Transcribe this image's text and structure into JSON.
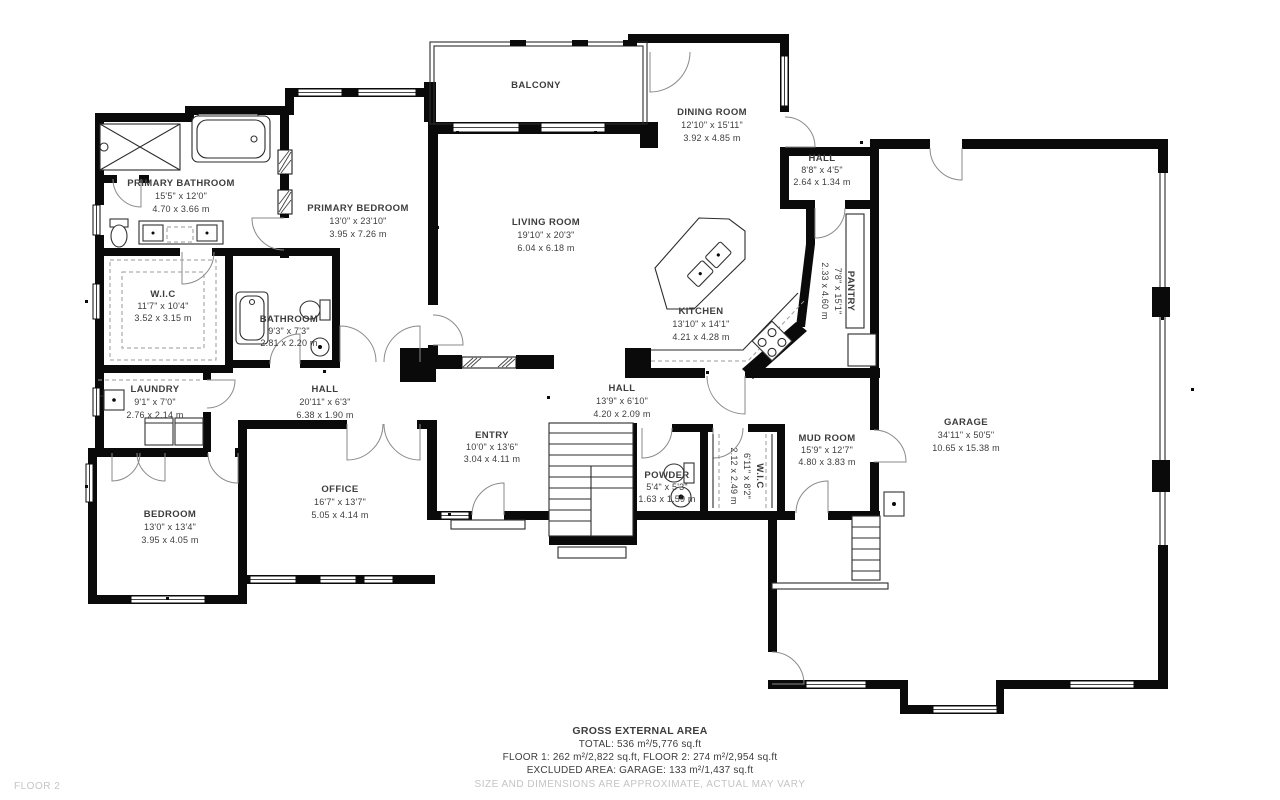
{
  "plan": {
    "floor_label": "FLOOR 2",
    "colors": {
      "wall": "#0a0a0a",
      "text": "#3d3d3d",
      "muted": "#c4c4c4",
      "background": "#ffffff"
    },
    "footer": {
      "title": "GROSS EXTERNAL AREA",
      "total": "TOTAL: 536 m²/5,776 sq.ft",
      "floors": "FLOOR 1: 262 m²/2,822 sq.ft, FLOOR 2: 274 m²/2,954 sq.ft",
      "excluded": "EXCLUDED AREA: GARAGE: 133 m²/1,437 sq.ft",
      "disclaimer": "SIZE AND DIMENSIONS ARE APPROXIMATE, ACTUAL MAY VARY"
    },
    "rooms": [
      {
        "id": "balcony",
        "name": "BALCONY",
        "dims_ft": "",
        "dims_m": ""
      },
      {
        "id": "primary-bathroom",
        "name": "PRIMARY BATHROOM",
        "dims_ft": "15'5\" x 12'0\"",
        "dims_m": "4.70 x 3.66 m"
      },
      {
        "id": "primary-bedroom",
        "name": "PRIMARY BEDROOM",
        "dims_ft": "13'0\" x 23'10\"",
        "dims_m": "3.95 x 7.26 m"
      },
      {
        "id": "dining-room",
        "name": "DINING ROOM",
        "dims_ft": "12'10\" x 15'11\"",
        "dims_m": "3.92 x 4.85 m"
      },
      {
        "id": "hall-upper",
        "name": "HALL",
        "dims_ft": "8'8\" x 4'5\"",
        "dims_m": "2.64 x 1.34 m"
      },
      {
        "id": "living-room",
        "name": "LIVING ROOM",
        "dims_ft": "19'10\" x 20'3\"",
        "dims_m": "6.04 x 6.18 m"
      },
      {
        "id": "pantry",
        "name": "PANTRY",
        "dims_ft": "7'8\" x 15'1\"",
        "dims_m": "2.33 x 4.60 m"
      },
      {
        "id": "kitchen",
        "name": "KITCHEN",
        "dims_ft": "13'10\" x 14'1\"",
        "dims_m": "4.21 x 4.28 m"
      },
      {
        "id": "wic-primary",
        "name": "W.I.C",
        "dims_ft": "11'7\" x 10'4\"",
        "dims_m": "3.52 x 3.15 m"
      },
      {
        "id": "bathroom",
        "name": "BATHROOM",
        "dims_ft": "9'3\" x 7'3\"",
        "dims_m": "2.81 x 2.20 m"
      },
      {
        "id": "laundry",
        "name": "LAUNDRY",
        "dims_ft": "9'1\" x 7'0\"",
        "dims_m": "2.76 x 2.14 m"
      },
      {
        "id": "hall-west",
        "name": "HALL",
        "dims_ft": "20'11\" x 6'3\"",
        "dims_m": "6.38 x 1.90 m"
      },
      {
        "id": "hall-center",
        "name": "HALL",
        "dims_ft": "13'9\" x 6'10\"",
        "dims_m": "4.20 x 2.09 m"
      },
      {
        "id": "entry",
        "name": "ENTRY",
        "dims_ft": "10'0\" x 13'6\"",
        "dims_m": "3.04 x 4.11 m"
      },
      {
        "id": "garage",
        "name": "GARAGE",
        "dims_ft": "34'11\" x 50'5\"",
        "dims_m": "10.65 x 15.38 m"
      },
      {
        "id": "mud-room",
        "name": "MUD ROOM",
        "dims_ft": "15'9\" x 12'7\"",
        "dims_m": "4.80 x 3.83 m"
      },
      {
        "id": "wic-mud",
        "name": "W.I.C",
        "dims_ft": "6'11\" x 8'2\"",
        "dims_m": "2.12 x 2.49 m"
      },
      {
        "id": "powder",
        "name": "POWDER",
        "dims_ft": "5'4\" x 5'3\"",
        "dims_m": "1.63 x 1.59 m"
      },
      {
        "id": "office",
        "name": "OFFICE",
        "dims_ft": "16'7\" x 13'7\"",
        "dims_m": "5.05 x 4.14 m"
      },
      {
        "id": "bedroom",
        "name": "BEDROOM",
        "dims_ft": "13'0\" x 13'4\"",
        "dims_m": "3.95 x 4.05 m"
      }
    ]
  }
}
